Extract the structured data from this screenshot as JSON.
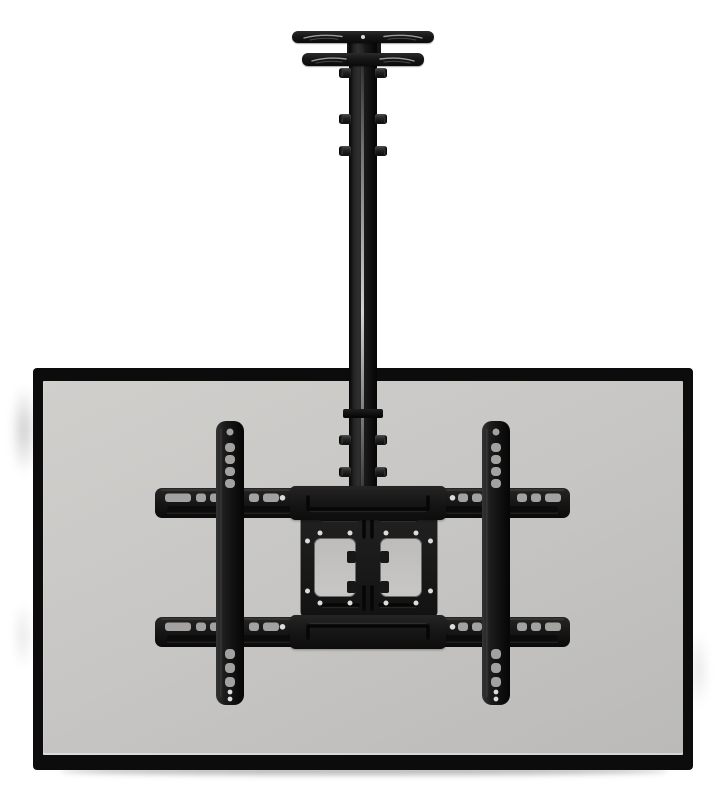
{
  "scene": {
    "type": "product-photo",
    "subject": "Ceiling-mount TV bracket with adjustable drop pole holding a flat-screen TV, rear view",
    "background": "#ffffff"
  },
  "colors": {
    "bg": "#ffffff",
    "tv_frame": "#0c0c0c",
    "panel_light": "#d0cfcc",
    "panel": "#c7c6c4",
    "panel_dark": "#bbbab8",
    "slot_gray": "#a3a2a0",
    "screw_dot": "#dcdcda",
    "metal": "#161616",
    "metal_light": "#2e2e2e"
  },
  "parts": {
    "ceiling_plate": {
      "name": "ceiling mounting plate",
      "arm_count": 2,
      "screw_hole_count": 1
    },
    "pole": {
      "name": "adjustable drop column",
      "adjustment_bolt_pairs": 5
    },
    "tv": {
      "name": "flat-screen TV rear panel"
    },
    "bracket": {
      "name": "full-motion TV bracket",
      "crossbar_count": 2,
      "rail_count": 2,
      "vesa_plate": {
        "name": "VESA adapter plate",
        "window_count": 2
      }
    }
  }
}
